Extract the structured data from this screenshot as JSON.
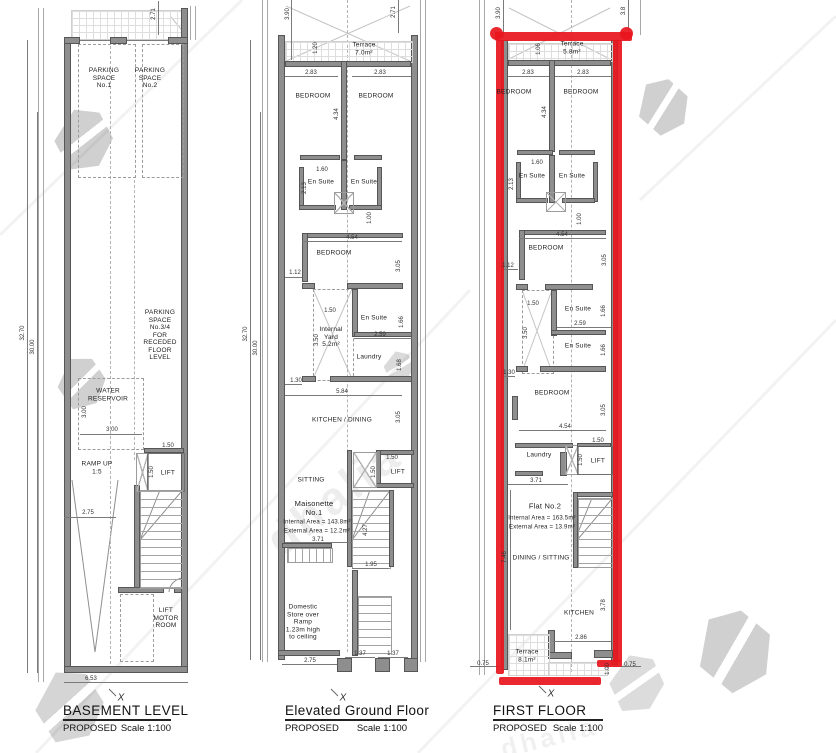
{
  "watermark": {
    "text": "dhalia"
  },
  "p1": {
    "title": "BASEMENT LEVEL",
    "proposed": "PROPOSED",
    "scale": "Scale 1:100",
    "xmark": "X",
    "rooms": {
      "parking1": "PARKING\nSPACE\nNo.1",
      "parking2": "PARKING\nSPACE\nNo.2",
      "parking34": "PARKING\nSPACE\nNo.3/4\nFOR\nRECEDED\nFLOOR\nLEVEL",
      "water": "WATER\nRESERVOIR",
      "ramp": "RAMP UP\n1:5",
      "lift": "LIFT",
      "liftmotor": "LIFT\nMOTOR\nROOM"
    },
    "dims": {
      "d271": "2.71",
      "d3270": "32.70",
      "d3000": "30.00",
      "d300": "3.00",
      "d275": "2.75",
      "d150": "1.50",
      "d653": "6.53"
    }
  },
  "p2": {
    "title": "Elevated Ground Floor",
    "proposed": "PROPOSED",
    "scale": "Scale 1:100",
    "xmark": "X",
    "rooms": {
      "terrace": "Terrace\n7.0m²",
      "bedroom": "BEDROOM",
      "ensuite": "En Suite",
      "yard": "Internal\nYard\n5.2m²",
      "laundry": "Laundry",
      "kitchen": "KITCHEN / DINING",
      "sitting": "SITTING",
      "lift": "LIFT",
      "store": "Domestic\nStore over\nRamp\n1.23m high\nto ceiling"
    },
    "unit": {
      "name": "Maisonette\nNo.1",
      "internal": "Internal Area  = 143.8m²",
      "external": "External Area =   12.2m²"
    },
    "dims": {
      "d390": "3.90",
      "d271": "2.71",
      "d120": "1.20",
      "d283": "2.83",
      "d434": "4.34",
      "d160": "1.60",
      "d213": "2.13",
      "d100": "1.00",
      "d454": "4.54",
      "d112": "1.12",
      "d305": "3.05",
      "d150": "1.50",
      "d350": "3.50",
      "d166": "1.66",
      "d259": "2.59",
      "d168": "1.68",
      "d130": "1.30",
      "d584": "5.84",
      "d371": "3.71",
      "d427": "4.27",
      "d195": "1.95",
      "d275": "2.75",
      "d137": "1.37",
      "d3270": "32.70",
      "d3000": "30.00"
    }
  },
  "p3": {
    "title": "FIRST FLOOR",
    "proposed": "PROPOSED",
    "scale": "Scale 1:100",
    "xmark": "X",
    "rooms": {
      "terrace_top": "Terrace\n5.8m²",
      "terrace_bottom": "Terrace\n8.1m²",
      "bedroom": "BEDROOM",
      "ensuite": "En Suite",
      "laundry": "Laundry",
      "kitchen": "KITCHEN",
      "dining": "DINING / SITTING",
      "lift": "LIFT"
    },
    "unit": {
      "name": "Flat No.2",
      "internal": "Internal Area  = 163.5m²",
      "external": "External Area =   13.9m²"
    },
    "dims": {
      "d390": "3.90",
      "d38": "3.8",
      "d106": "1.06",
      "d283": "2.83",
      "d434": "4.34",
      "d160": "1.60",
      "d213": "2.13",
      "d100": "1.00",
      "d454": "4.54",
      "d112": "1.12",
      "d305": "3.05",
      "d150": "1.50",
      "d350": "3.50",
      "d166": "1.66",
      "d259": "2.59",
      "d130": "1.30",
      "d371": "3.71",
      "d746": "7.46",
      "d378": "3.78",
      "d286": "2.86",
      "d075": "0.75"
    }
  }
}
